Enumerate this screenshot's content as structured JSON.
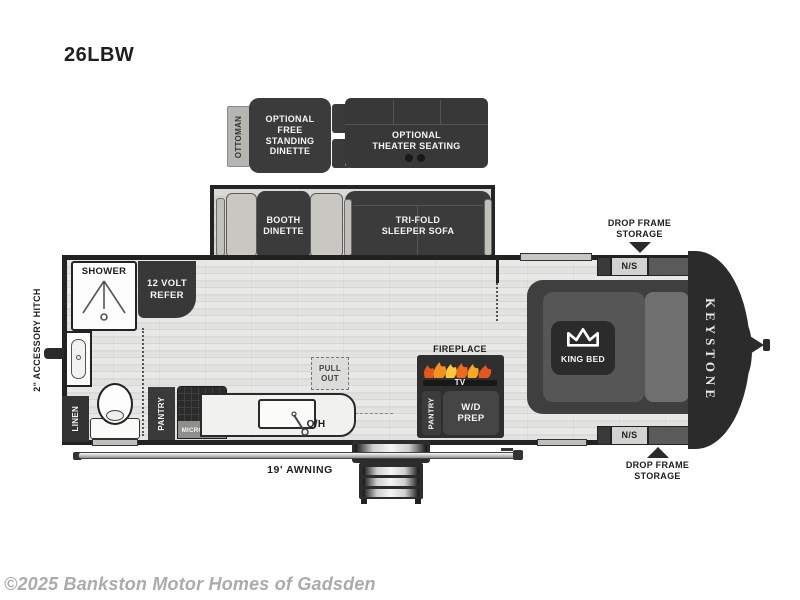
{
  "title": "26LBW",
  "watermark": "©2025 Bankston Motor Homes of Gadsden",
  "colors": {
    "wall": "#222222",
    "furniture_dark": "#3a3a3a",
    "floor_light": "#e4e4e2",
    "flame_orange": "#f07a1e",
    "flame_yellow": "#ffc937"
  },
  "optional": {
    "ottoman": "OTTOMAN",
    "free_standing_dinette": "OPTIONAL\nFREE\nSTANDING\nDINETTE",
    "theater_seating": "OPTIONAL\nTHEATER SEATING"
  },
  "slide": {
    "booth_dinette": "BOOTH\nDINETTE",
    "sofa": "TRI-FOLD\nSLEEPER SOFA",
    "storage_drawer_left": "STORAGE\nDRAWER",
    "storage_drawer_right": "STORAGE\nDRAWER"
  },
  "bath": {
    "shower": "SHOWER",
    "refer": "12 VOLT\nREFER",
    "linen": "LINEN"
  },
  "kitchen": {
    "pantry": "PANTRY",
    "microwave": "MICROWAVE",
    "overhead": "O/H",
    "pull_out": "PULL\nOUT"
  },
  "media": {
    "fireplace": "FIREPLACE",
    "tv": "TV",
    "pantry": "PANTRY",
    "wd_prep": "W/D\nPREP"
  },
  "bedroom": {
    "king_bed": "KING BED",
    "ns_top": "N/S",
    "ns_bottom": "N/S"
  },
  "exterior": {
    "accessory_hitch": "2\" ACCESSORY HITCH",
    "awning": "19' AWNING",
    "drop_frame_top": "DROP FRAME\nSTORAGE",
    "drop_frame_bottom": "DROP FRAME\nSTORAGE",
    "brand": "KEYSTONE"
  }
}
